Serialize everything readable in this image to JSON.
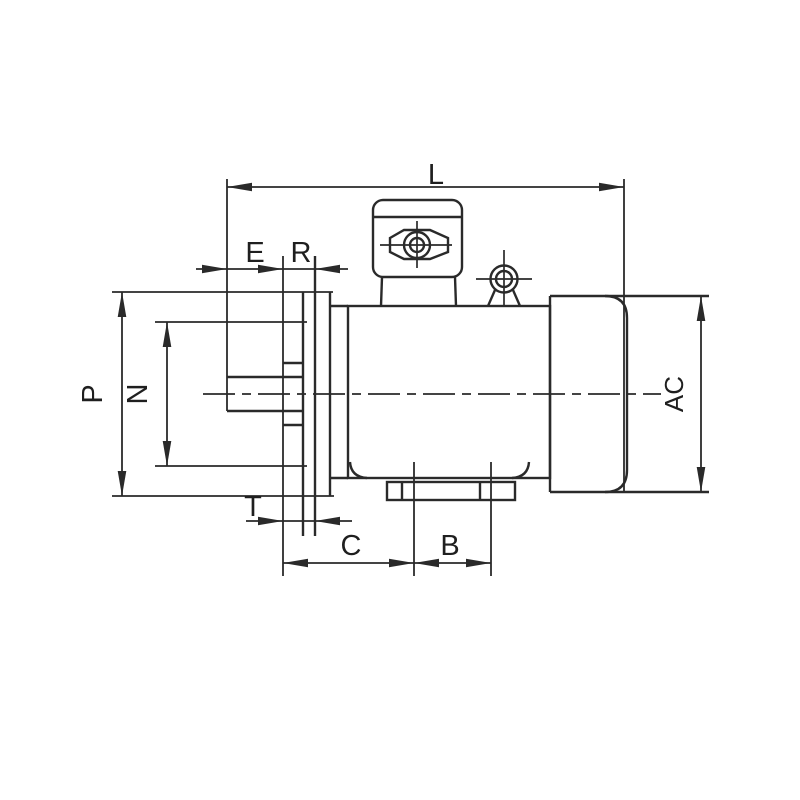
{
  "drawing": {
    "kind": "motor-outline-dimension-drawing",
    "background_color": "#ffffff",
    "line_color": "#2a2a2a",
    "dimension_labels": {
      "L": "L",
      "E": "E",
      "R": "R",
      "P": "P",
      "N": "N",
      "T": "T",
      "C": "C",
      "B": "B",
      "AC": "AC"
    }
  }
}
